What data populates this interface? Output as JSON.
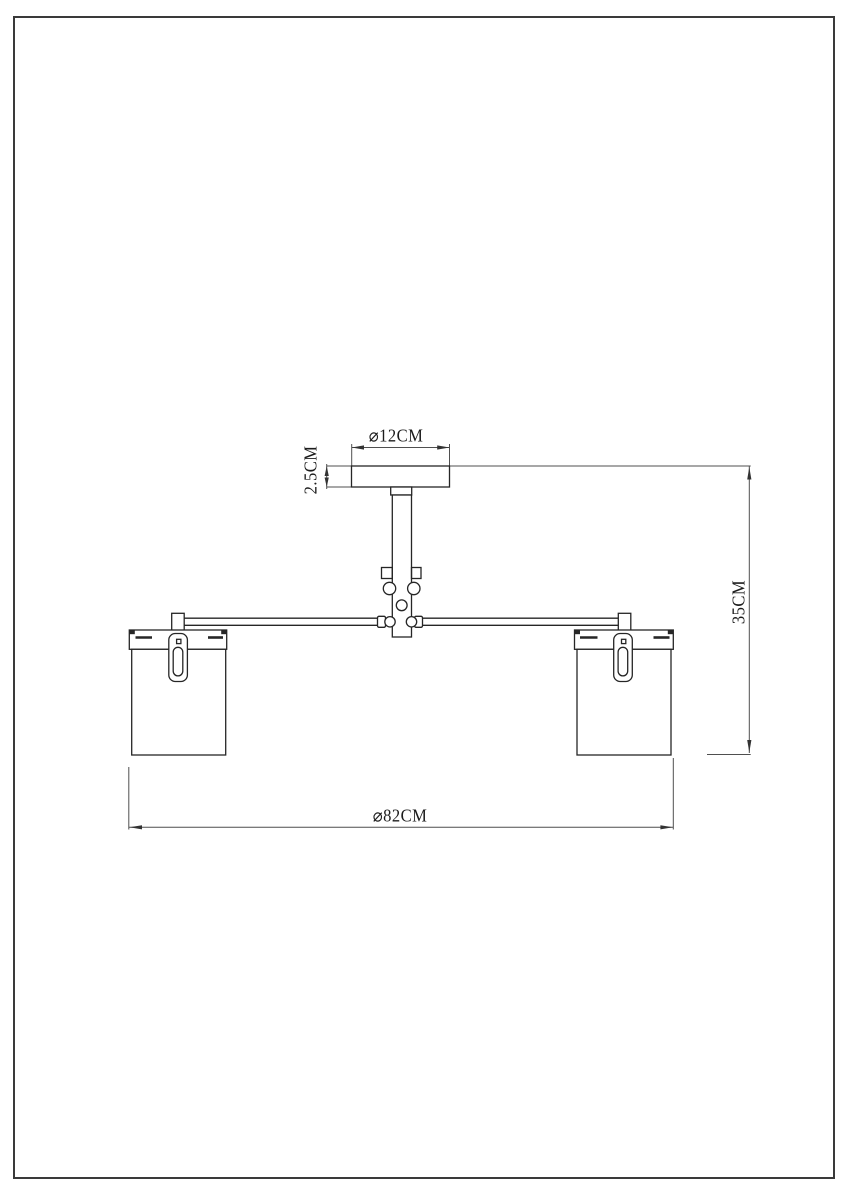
{
  "sheet": {
    "background": "#ffffff",
    "border_color": "#3a3a3a"
  },
  "colors": {
    "object_line": "#262626",
    "dimension_line": "#4f4f4f",
    "text": "#1c1c1c"
  },
  "labels": {
    "canopy_diameter": "⌀12CM",
    "canopy_height": "2.5CM",
    "overall_height": "35CM",
    "overall_diameter": "⌀82CM"
  }
}
